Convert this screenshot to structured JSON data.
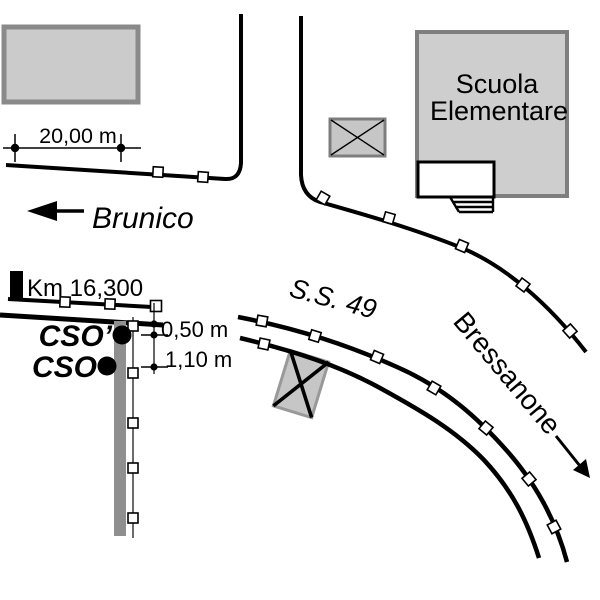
{
  "labels": {
    "school_line1": "Scuola",
    "school_line2": "Elementare",
    "direction_west": "Brunico",
    "direction_east": "Bressanone",
    "road_name": "S.S. 49",
    "km_marker": "Km 16,300",
    "point_cso_prime": "CSO’",
    "point_cso": "CSO",
    "dim_building_offset": "20,00 m",
    "dim_offset_small": "0,50 m",
    "dim_offset_large": "1,10 m"
  },
  "colors": {
    "background": "#ffffff",
    "line": "#000000",
    "building_fill": "#cbcbcb",
    "building_border": "#8a8a8a",
    "school_fill": "#cecece",
    "school_border": "#7f7f7f",
    "crossed_box_fill": "#c6c6c6",
    "crossed_box_border": "#858585",
    "wall_fill": "#8f8f8f",
    "marker_fill": "#ffffff"
  }
}
